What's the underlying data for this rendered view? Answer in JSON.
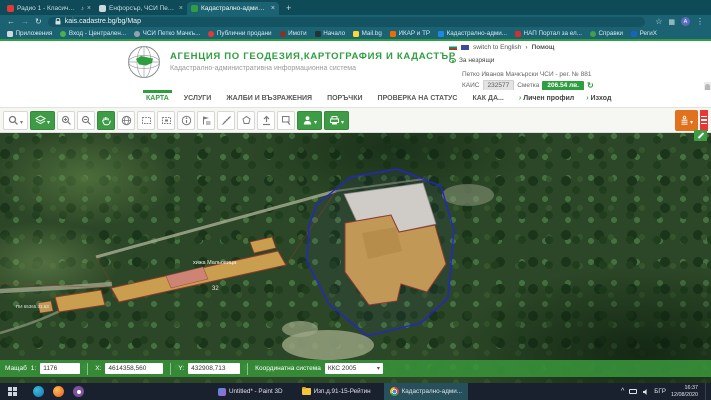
{
  "colors": {
    "accent_green": "#2f9e41",
    "toolbar_green": "#3f9c46",
    "orange_button": "#e2711d",
    "red_menu": "#e53935",
    "parcel_outline_blue": "#2323d8",
    "building_fill": "#c99e4f",
    "browser_frame_teal": "#0e4a57"
  },
  "browser": {
    "tabs": [
      {
        "title": "Радио 1 - Класическите..."
      },
      {
        "title": "Енфорсър, ЧСИ Петко Мачкъ..."
      },
      {
        "title": "Кадастрално-административн..."
      }
    ],
    "close_glyph": "×",
    "new_tab": "+",
    "url": "kais.cadastre.bg/bg/Map",
    "avatar_letter": "А",
    "bookmarks": [
      {
        "label": "Приложения"
      },
      {
        "label": "Вход - Централен..."
      },
      {
        "label": "ЧСИ Петко Мачкъ..."
      },
      {
        "label": "Публични продани"
      },
      {
        "label": "Имоти"
      },
      {
        "label": "Начало"
      },
      {
        "label": "Mail.bg"
      },
      {
        "label": "ИКАР и ТР"
      },
      {
        "label": "Кадастрално-адми..."
      },
      {
        "label": "НАП Портал за ел..."
      },
      {
        "label": "Справки"
      },
      {
        "label": "РегиХ"
      }
    ]
  },
  "header": {
    "title": "АГЕНЦИЯ ПО ГЕОДЕЗИЯ,КАРТОГРАФИЯ И КАДАСТЪР",
    "subtitle": "Кадастрално-административна информационна система",
    "switch_language": "switch to English",
    "help": "Помощ",
    "accessibility": "За незрящи",
    "user": "Петко Иванов Мачкърски ЧСИ - рег. № 881",
    "kais_label": "КАИС",
    "kais_value": "232577",
    "account_label": "Сметка",
    "balance": "206.54 лв."
  },
  "nav": {
    "items": [
      {
        "label": "КАРТА"
      },
      {
        "label": "УСЛУГИ"
      },
      {
        "label": "ЖАЛБИ И ВЪЗРАЖЕНИЯ"
      },
      {
        "label": "ПОРЪЧКИ"
      },
      {
        "label": "ПРОВЕРКА НА СТАТУС"
      },
      {
        "label": "КАК ДА..."
      }
    ],
    "profile": "Личен профил",
    "logout": "Изход"
  },
  "map": {
    "labels": {
      "hut": "хижа Мальовица",
      "building_no": "32",
      "parcel": "ПИ 65365.31.53"
    }
  },
  "statusbar": {
    "scale_label": "Мащаб",
    "scale_prefix": "1:",
    "scale_value": "1176",
    "x_label": "X:",
    "x_value": "4614358,560",
    "y_label": "Y:",
    "y_value": "432908,713",
    "crs_label": "Координатна система",
    "crs_value": "ККС 2005"
  },
  "taskbar": {
    "tasks": [
      {
        "label": "Untitled* - Paint 3D"
      },
      {
        "label": "Изп.д.91-15-Рейтин"
      },
      {
        "label": "Кадастрално-адми..."
      }
    ],
    "tray": {
      "lang": "БГР",
      "time": "16:37",
      "date": "12/08/2020"
    }
  }
}
